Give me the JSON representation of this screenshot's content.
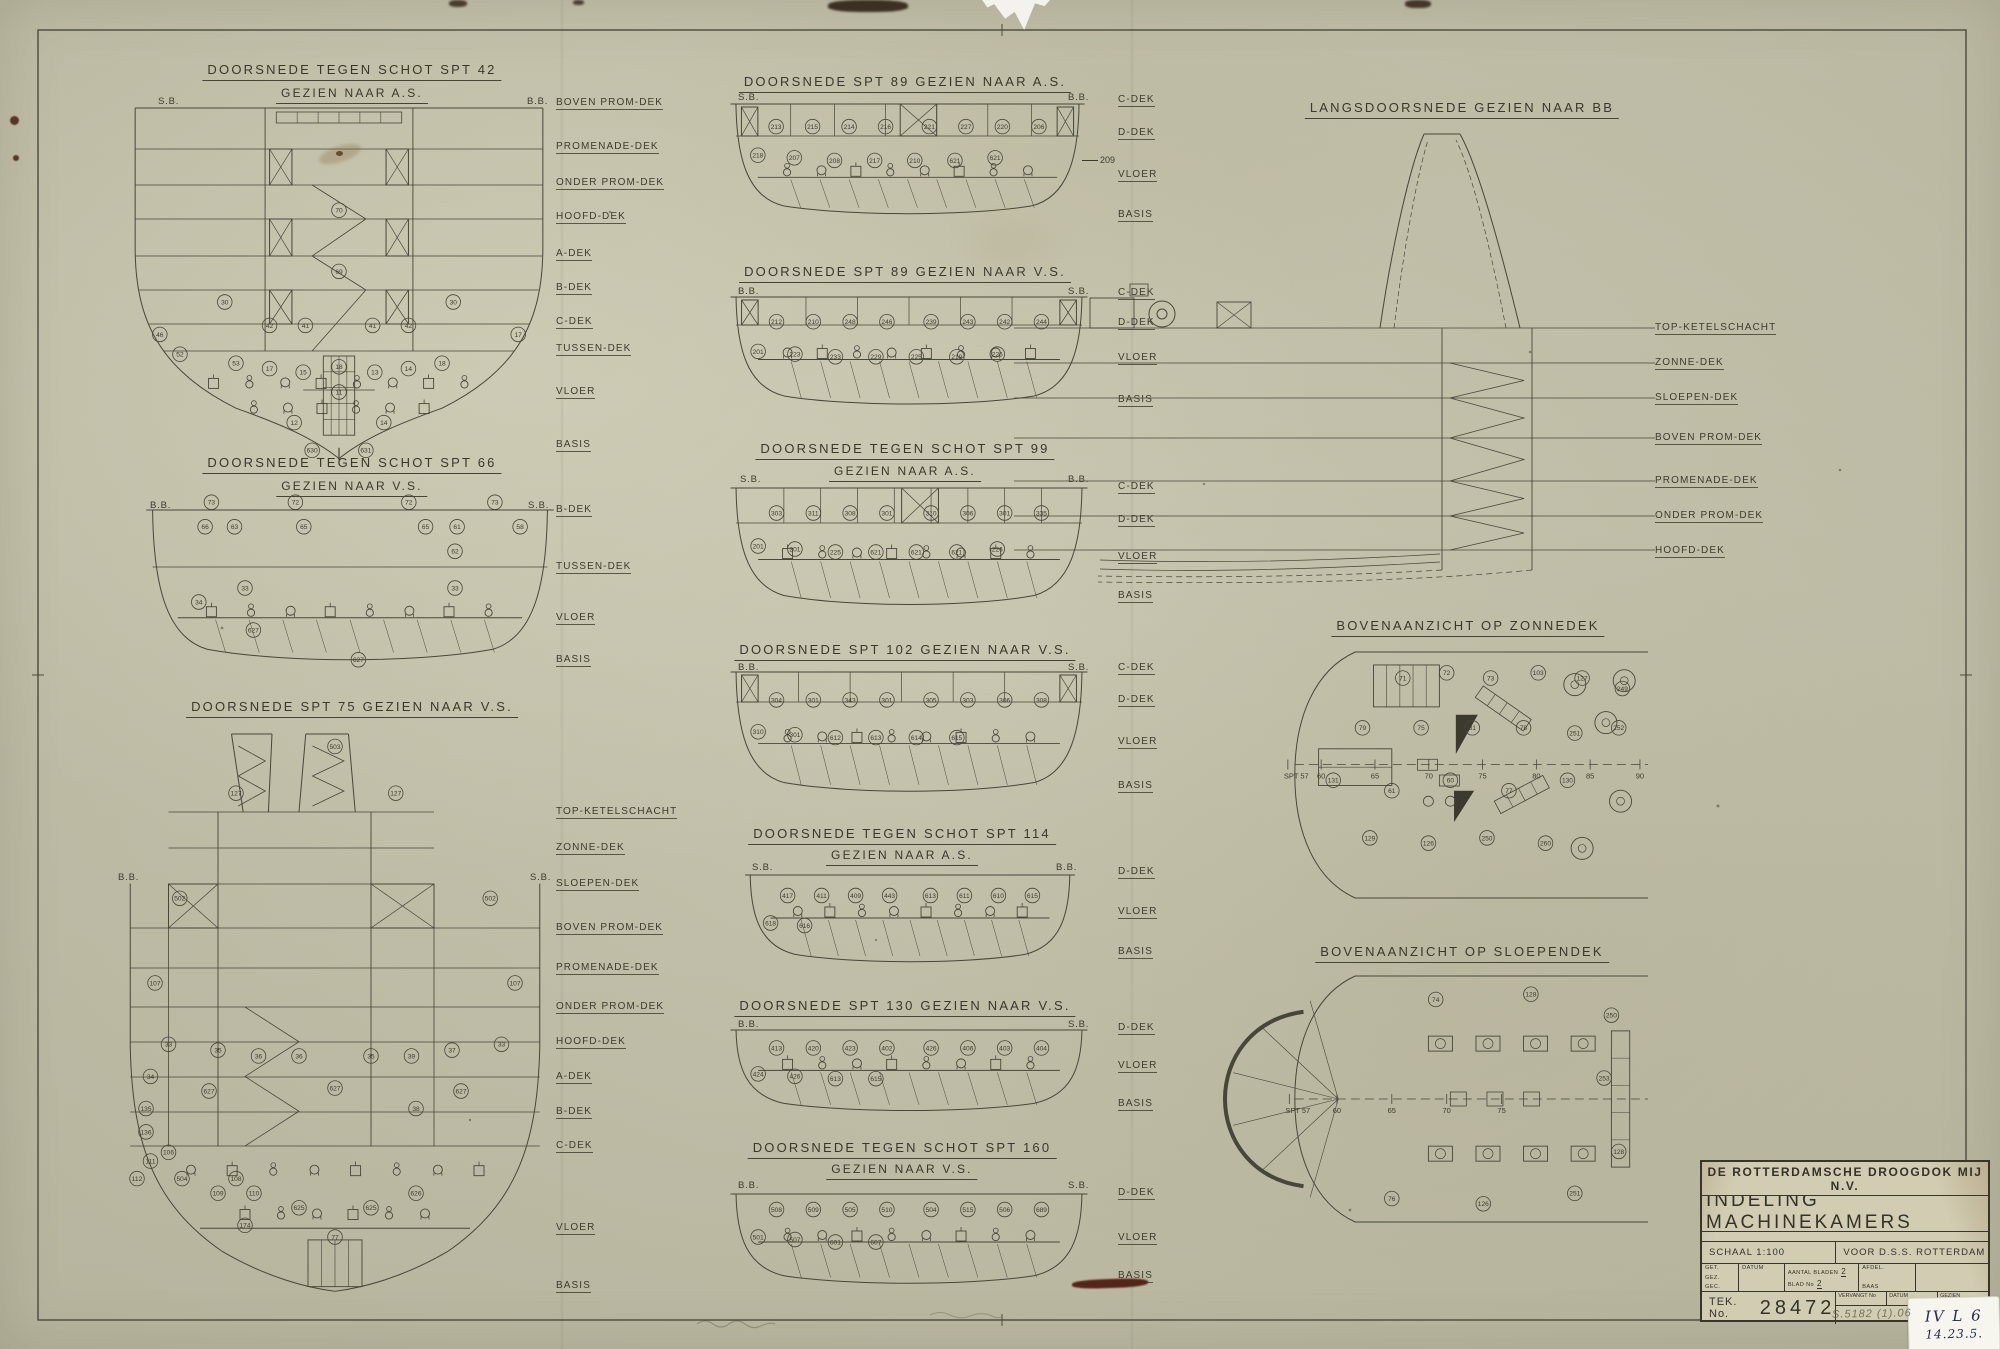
{
  "sheet": {
    "paper_color": "#c7c5af",
    "line_color": "#47463a",
    "background_color": "#e7e6e1"
  },
  "sections": {
    "s42": {
      "title": "DOORSNEDE TEGEN SCHOT SPT 42",
      "subtitle": "GEZIEN NAAR A.S.",
      "corner_left": "S.B.",
      "corner_right": "B.B.",
      "decks": [
        "BOVEN PROM-DEK",
        "PROMENADE-DEK",
        "ONDER PROM-DEK",
        "HOOFD-DEK",
        "A-DEK",
        "B-DEK",
        "C-DEK",
        "TUSSEN-DEK",
        "VLOER",
        "BASIS"
      ],
      "callouts": [
        "70",
        "69",
        "30",
        "30",
        "42",
        "41",
        "41",
        "42",
        "46",
        "17",
        "52",
        "53",
        "17",
        "15",
        "18",
        "13",
        "14",
        "18",
        "11",
        "12",
        "14",
        "630",
        "631"
      ]
    },
    "s66": {
      "title": "DOORSNEDE TEGEN SCHOT SPT 66",
      "subtitle": "GEZIEN NAAR V.S.",
      "corner_left": "B.B.",
      "corner_right": "S.B.",
      "decks": [
        "B-DEK",
        "TUSSEN-DEK",
        "VLOER",
        "BASIS"
      ],
      "callouts": [
        "73",
        "72",
        "72",
        "73",
        "66",
        "63",
        "65",
        "65",
        "61",
        "58",
        "62",
        "33",
        "33",
        "34",
        "627",
        "627"
      ]
    },
    "s75": {
      "title": "DOORSNEDE SPT 75 GEZIEN NAAR V.S.",
      "corner_left": "B.B.",
      "corner_right": "S.B.",
      "decks": [
        "TOP-KETELSCHACHT",
        "ZONNE-DEK",
        "SLOEPEN-DEK",
        "BOVEN PROM-DEK",
        "PROMENADE-DEK",
        "ONDER PROM-DEK",
        "HOOFD-DEK",
        "A-DEK",
        "B-DEK",
        "C-DEK",
        "VLOER",
        "BASIS"
      ],
      "callouts": [
        "503",
        "127",
        "127",
        "502",
        "502",
        "107",
        "107",
        "33",
        "35",
        "36",
        "36",
        "35",
        "39",
        "37",
        "33",
        "34",
        "627",
        "627",
        "627",
        "38",
        "135",
        "136",
        "106",
        "111",
        "112",
        "504",
        "108",
        "109",
        "110",
        "625",
        "625",
        "626",
        "174",
        "77"
      ]
    },
    "b1": {
      "title": "DOORSNEDE SPT 89 GEZIEN NAAR A.S.",
      "corner_left": "S.B.",
      "corner_right": "B.B.",
      "decks": [
        "C-DEK",
        "D-DEK",
        "VLOER",
        "BASIS"
      ],
      "side_note": "209",
      "callouts": [
        "213",
        "215",
        "214",
        "216",
        "221",
        "227",
        "220",
        "206",
        "218",
        "207",
        "208",
        "217",
        "210",
        "621",
        "621"
      ]
    },
    "b2": {
      "title": "DOORSNEDE SPT 89 GEZIEN NAAR V.S.",
      "corner_left": "B.B.",
      "corner_right": "S.B.",
      "decks": [
        "C-DEK",
        "D-DEK",
        "VLOER",
        "BASIS"
      ],
      "callouts": [
        "212",
        "210",
        "248",
        "246",
        "239",
        "243",
        "242",
        "244",
        "201",
        "223",
        "233",
        "229",
        "225",
        "219",
        "226"
      ]
    },
    "b3": {
      "title": "DOORSNEDE TEGEN SCHOT SPT 99",
      "subtitle": "GEZIEN NAAR A.S.",
      "corner_left": "S.B.",
      "corner_right": "B.B.",
      "decks": [
        "C-DEK",
        "D-DEK",
        "VLOER",
        "BASIS"
      ],
      "callouts": [
        "303",
        "311",
        "308",
        "301",
        "310",
        "306",
        "301",
        "335",
        "201",
        "201",
        "225",
        "621",
        "621",
        "621",
        "226"
      ]
    },
    "b4": {
      "title": "DOORSNEDE SPT 102 GEZIEN NAAR V.S.",
      "corner_left": "B.B.",
      "corner_right": "S.B.",
      "decks": [
        "C-DEK",
        "D-DEK",
        "VLOER",
        "BASIS"
      ],
      "callouts": [
        "304",
        "301",
        "343",
        "301",
        "305",
        "303",
        "306",
        "308",
        "310",
        "301",
        "612",
        "613",
        "614",
        "615"
      ]
    },
    "b5": {
      "title": "DOORSNEDE TEGEN SCHOT SPT 114",
      "subtitle": "GEZIEN NAAR A.S.",
      "corner_left": "S.B.",
      "corner_right": "B.B.",
      "decks": [
        "D-DEK",
        "VLOER",
        "BASIS"
      ],
      "callouts": [
        "417",
        "411",
        "409",
        "443",
        "613",
        "611",
        "610",
        "615",
        "618",
        "616"
      ]
    },
    "b6": {
      "title": "DOORSNEDE SPT 130 GEZIEN NAAR V.S.",
      "corner_left": "B.B.",
      "corner_right": "S.B.",
      "decks": [
        "D-DEK",
        "VLOER",
        "BASIS"
      ],
      "callouts": [
        "413",
        "420",
        "423",
        "402",
        "426",
        "406",
        "403",
        "404",
        "424",
        "426",
        "613",
        "615"
      ]
    },
    "b7": {
      "title": "DOORSNEDE TEGEN SCHOT SPT 160",
      "subtitle": "GEZIEN NAAR V.S.",
      "corner_left": "B.B.",
      "corner_right": "S.B.",
      "decks": [
        "D-DEK",
        "VLOER",
        "BASIS"
      ],
      "callouts": [
        "508",
        "509",
        "505",
        "510",
        "504",
        "515",
        "506",
        "689",
        "501",
        "507",
        "601",
        "607"
      ]
    },
    "c1": {
      "title": "LANGSDOORSNEDE GEZIEN NAAR BB",
      "decks": [
        "TOP-KETELSCHACHT",
        "ZONNE-DEK",
        "SLOEPEN-DEK",
        "BOVEN PROM-DEK",
        "PROMENADE-DEK",
        "ONDER PROM-DEK",
        "HOOFD-DEK"
      ],
      "callouts": []
    },
    "c2": {
      "title": "BOVENAANZICHT OP ZONNEDEK",
      "frames": [
        "SPT 57",
        "60",
        "65",
        "70",
        "75",
        "80",
        "85",
        "90"
      ],
      "callouts": [
        "71",
        "72",
        "73",
        "103",
        "127",
        "249",
        "79",
        "75",
        "81",
        "78",
        "251",
        "252",
        "131",
        "61",
        "60",
        "77",
        "130",
        "129",
        "126",
        "250",
        "260"
      ]
    },
    "c3": {
      "title": "BOVENAANZICHT OP SLOEPENDEK",
      "frames": [
        "SPT 57",
        "60",
        "65",
        "70",
        "75"
      ],
      "callouts": [
        "74",
        "128",
        "250",
        "253",
        "76",
        "126",
        "251",
        "128"
      ]
    }
  },
  "title_block": {
    "company": "DE ROTTERDAMSCHE DROOGDOK MIJ N.V.",
    "department": "AFD. WERKTUIGBOUW",
    "drawing_title": "INDELING MACHINEKAMERS",
    "scale_label": "SCHAAL 1:100",
    "client": "VOOR D.S.S. ROTTERDAM",
    "fields": {
      "get": "GET.",
      "gez": "GEZ.",
      "gec": "GEC.",
      "datum": "DATUM",
      "aantal_bladen": "AANTAL BLADEN",
      "aantal_value": "2",
      "blad_no": "BLAD No",
      "blad_value": "2",
      "afdel": "AFDEL.",
      "baas": "BAAS",
      "vervangt": "VERVANGT No",
      "datum2": "DATUM",
      "gezien": "GEZIEN"
    },
    "tek_label": "TEK. No.",
    "tek_value": "28472"
  },
  "annotations": {
    "pencil_note": "S.5182 (1).06",
    "sticker_line1": "IV L 6",
    "sticker_line2": "14.23.5."
  }
}
